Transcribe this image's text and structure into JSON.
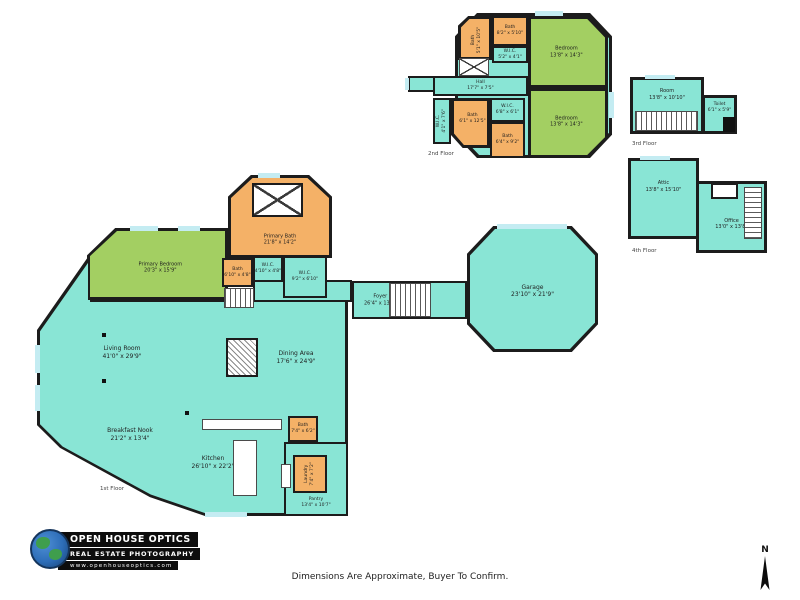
{
  "meta": {
    "disclaimer": "Dimensions Are Approximate, Buyer To Confirm.",
    "north_label": "N"
  },
  "branding": {
    "company": "OPEN HOUSE OPTICS",
    "tagline": "REAL ESTATE PHOTOGRAPHY",
    "website": "www.openhouseoptics.com"
  },
  "colors": {
    "room_teal": "#89E5D5",
    "bedroom_green": "#A3CF62",
    "bath_orange": "#F4B167",
    "wall": "#1C1C1C",
    "window": "#C4ECF2"
  },
  "floors": [
    {
      "label": "1st Floor",
      "rooms": [
        {
          "name": "Primary Bedroom",
          "dims": "20'3\" x 15'9\""
        },
        {
          "name": "Primary Bath",
          "dims": "21'8\" x 14'2\""
        },
        {
          "name": "Bath",
          "dims": "6'10\" x 4'8\""
        },
        {
          "name": "W.I.C.",
          "dims": "4'10\" x 4'8\""
        },
        {
          "name": "W.I.C.",
          "dims": "9'2\" x 6'10\""
        },
        {
          "name": "Living Room",
          "dims": "41'0\" x 29'9\""
        },
        {
          "name": "Dining Area",
          "dims": "17'6\" x 24'9\""
        },
        {
          "name": "Breakfast Nook",
          "dims": "21'2\" x 13'4\""
        },
        {
          "name": "Kitchen",
          "dims": "26'10\" x 22'2\""
        },
        {
          "name": "Foyer",
          "dims": "26'4\" x 13'5\""
        },
        {
          "name": "Garage",
          "dims": "23'10\" x 21'9\""
        },
        {
          "name": "Bath",
          "dims": "7'4\" x 6'2\""
        },
        {
          "name": "Laundry",
          "dims": "7'4\" x 7'2\""
        },
        {
          "name": "Pantry",
          "dims": "13'4\" x 10'7\""
        }
      ]
    },
    {
      "label": "2nd Floor",
      "rooms": [
        {
          "name": "Bath",
          "dims": "5'1\" x 10'5\""
        },
        {
          "name": "Bath",
          "dims": "8'2\" x 5'10\""
        },
        {
          "name": "W.I.C.",
          "dims": "5'2\" x 4'1\""
        },
        {
          "name": "Bedroom",
          "dims": "13'8\" x 14'3\""
        },
        {
          "name": "Hall",
          "dims": "17'7\" x 7'5\""
        },
        {
          "name": "W.I.C.",
          "dims": "4'1\" x 7'6\""
        },
        {
          "name": "Bath",
          "dims": "6'1\" x 12'5\""
        },
        {
          "name": "W.I.C.",
          "dims": "6'8\" x 6'1\""
        },
        {
          "name": "Bath",
          "dims": "6'4\" x 9'2\""
        },
        {
          "name": "Bedroom",
          "dims": "13'8\" x 14'3\""
        }
      ]
    },
    {
      "label": "3rd Floor",
      "rooms": [
        {
          "name": "Room",
          "dims": "13'8\" x 10'10\""
        },
        {
          "name": "Toilet",
          "dims": "6'1\" x 5'9\""
        }
      ]
    },
    {
      "label": "4th Floor",
      "rooms": [
        {
          "name": "Attic",
          "dims": "13'8\" x 15'10\""
        },
        {
          "name": "Office",
          "dims": "13'0\" x 13'8\""
        }
      ]
    }
  ]
}
